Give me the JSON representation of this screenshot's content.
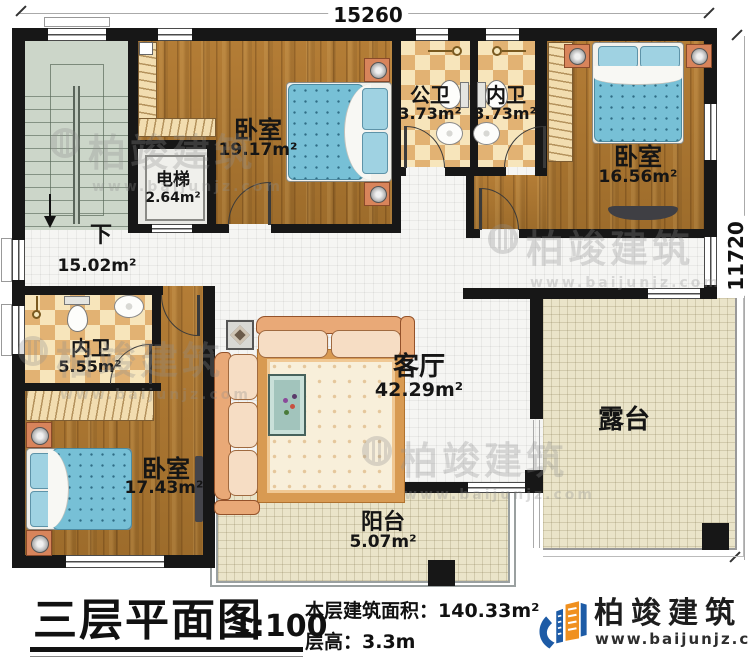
{
  "dimensions": {
    "top": "15260",
    "right": "11720"
  },
  "labels": {
    "stairs_down": "下",
    "corridor_area": "15.02m²"
  },
  "rooms": {
    "bedroom_top": {
      "name": "卧室",
      "area": "19.17m²"
    },
    "public_bath": {
      "name": "公卫",
      "area": "3.73m²"
    },
    "inner_bath_top": {
      "name": "内卫",
      "area": "3.73m²"
    },
    "bedroom_right": {
      "name": "卧室",
      "area": "16.56m²"
    },
    "elevator": {
      "name": "电梯",
      "area": "2.64m²"
    },
    "inner_bath_left": {
      "name": "内卫",
      "area": "5.55m²"
    },
    "bedroom_bottom": {
      "name": "卧室",
      "area": "17.43m²"
    },
    "living_room": {
      "name": "客厅",
      "area": "42.29m²"
    },
    "terrace": {
      "name": "露台"
    },
    "balcony": {
      "name": "阳台",
      "area": "5.07m²"
    }
  },
  "title_block": {
    "plan_title": "三层平面图",
    "scale": "1:100",
    "floor_area": "本层建筑面积：140.33m²",
    "floor_height": "层高：3.3m"
  },
  "brand": {
    "name": "柏竣建筑",
    "website": "www.baijunjz.com"
  },
  "watermark": {
    "name": "柏竣建筑",
    "website": "www.baijunjz.com"
  },
  "colors": {
    "wall": "#171717",
    "wood_floor": "#a8732e",
    "bath_tile_light": "#f7e5bb",
    "bath_tile_dark": "#e2b273",
    "bed_blue": "#77c0d6",
    "outdoor_tile": "#eae4c9",
    "stair_green": "#ccd6c9",
    "logo_blue": "#1d5ba6",
    "logo_orange": "#f0901e"
  }
}
